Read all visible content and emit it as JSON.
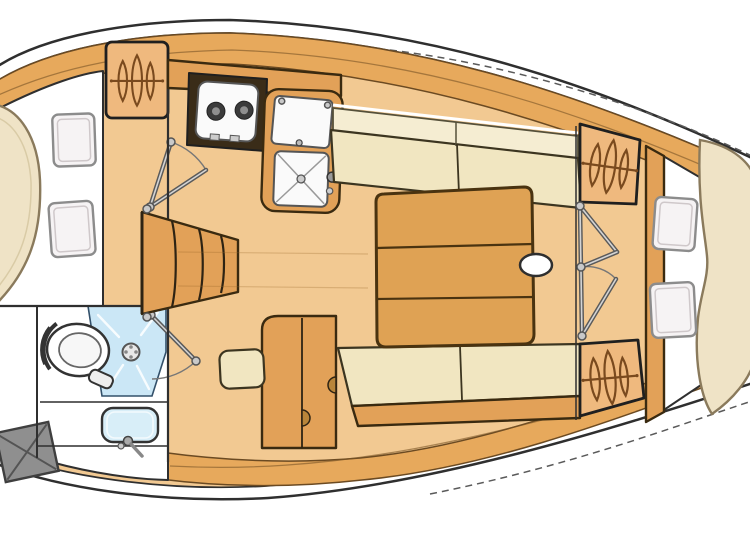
{
  "plan": {
    "type": "sailboat-interior-floor-plan",
    "bow_direction": "right",
    "rooms": [
      {
        "id": "aft-cabin",
        "items": [
          "double-berth-mattress",
          "pillow",
          "pillow",
          "hanging-locker",
          "cabin-door"
        ]
      },
      {
        "id": "head",
        "items": [
          "toilet",
          "shower",
          "shower-drain",
          "washbasin",
          "faucet",
          "storage-hatch",
          "door"
        ]
      },
      {
        "id": "companionway",
        "items": [
          "steps"
        ]
      },
      {
        "id": "galley",
        "items": [
          "two-burner-stove",
          "icebox",
          "sink",
          "faucet",
          "counter"
        ]
      },
      {
        "id": "salon",
        "items": [
          "settee-starboard",
          "settee-port",
          "folding-table",
          "mast-post",
          "cabinet",
          "seat-cushion"
        ]
      },
      {
        "id": "forward-cabin",
        "items": [
          "v-berth-mattress",
          "pillow",
          "pillow",
          "hanging-locker",
          "hanging-locker",
          "bifold-doors"
        ]
      }
    ]
  },
  "colors": {
    "background": "#ffffff",
    "hullLine": "#2f2f2f",
    "hullBand": "#E7A95C",
    "floor": "#F2C992",
    "woodMid": "#E2A158",
    "woodDark": "#4a3310",
    "tableWood": "#DFA254",
    "cushionCream": "#F1E6C1",
    "cushionBack": "#F5EDD2",
    "mattress": "#EFE3C6",
    "pillow": "#F6F3F4",
    "pillowStroke": "#8c8c8c",
    "lockerFill": "#EFB97E",
    "lockerGlyph": "#7A4A1E",
    "metal": "#5a5a5a",
    "metalLight": "#d4d4d4",
    "showerBlue": "#CBE7F6",
    "sinkBlue": "#D8EEF8",
    "applianceWhite": "#FAFAFA",
    "burner": "#3b3b3b",
    "hatchGray": "#8f8f8f",
    "outline": "#2b2b2b"
  }
}
